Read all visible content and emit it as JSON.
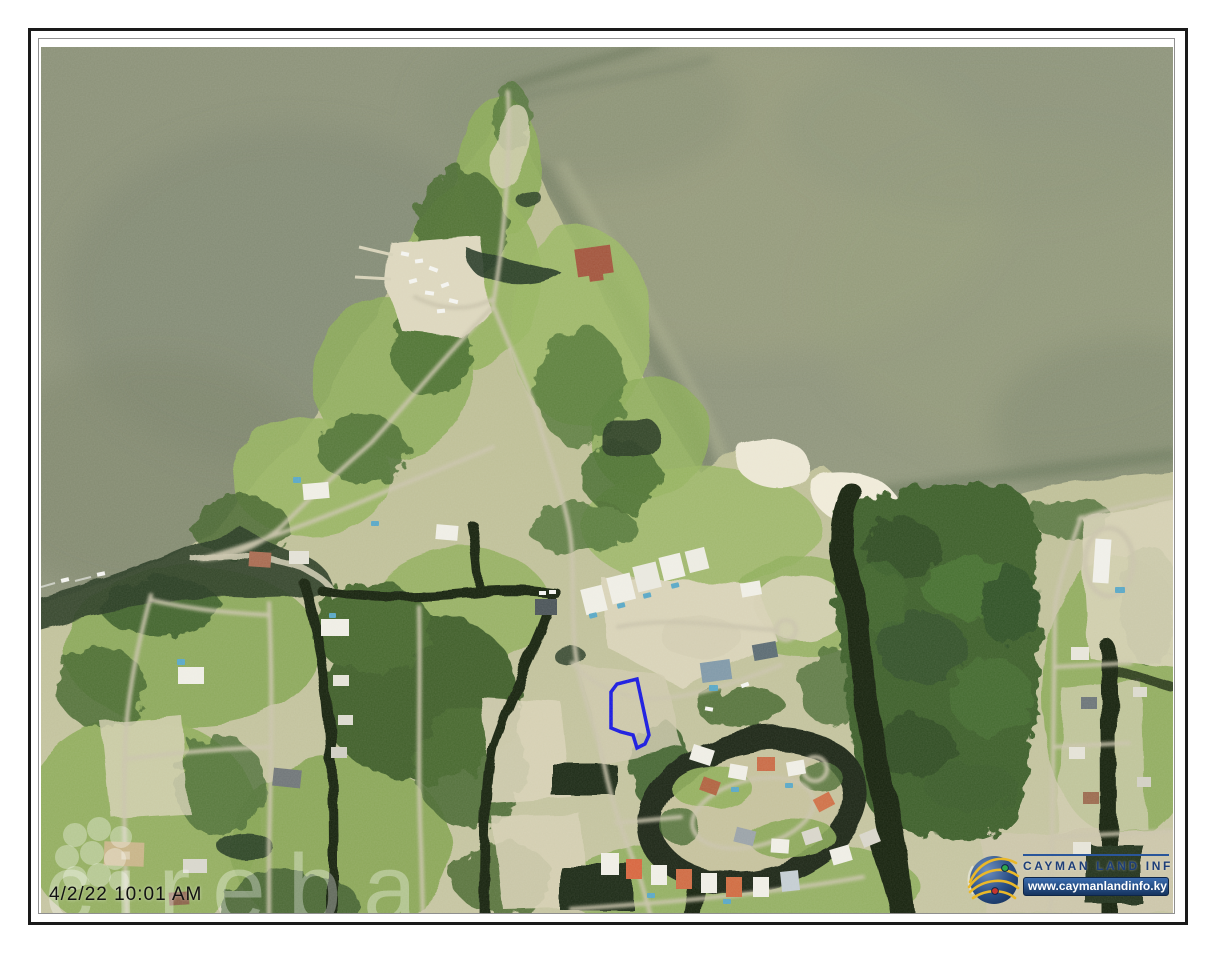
{
  "sheet": {
    "background": "#ffffff",
    "border_color": "#1a1a1a"
  },
  "map": {
    "type": "aerial-orthophoto",
    "timestamp": "4/2/22 10:01 AM",
    "parcel": {
      "outline_color": "#1717e0"
    },
    "watermark": {
      "text": "cireba",
      "icon": "flower-cluster-icon",
      "color": "rgba(255,255,255,0.33)"
    },
    "provider": {
      "name": "CAYMAN LAND INFO",
      "website": "www.caymanlandinfo.ky",
      "icon": "globe-orbits-icon",
      "name_color": "#1d3e78"
    }
  },
  "palette": {
    "sea": "#8e947c",
    "sea_light": "#9ba17f",
    "sea_dark": "#75806a",
    "land": "#c3c29d",
    "vegetation": "#8cab58",
    "trees_dark": "#3f5f2c",
    "mangrove": "#3c5e2c",
    "sand": "#dcd6bc",
    "sand_bright": "#ece7d4",
    "road": "#c9c3ab",
    "canal": "#18240f",
    "bay": "#2a3a26",
    "house_white": "#efeee6",
    "roof_red": "#b4674a",
    "pool_blue": "#58a7c6"
  }
}
